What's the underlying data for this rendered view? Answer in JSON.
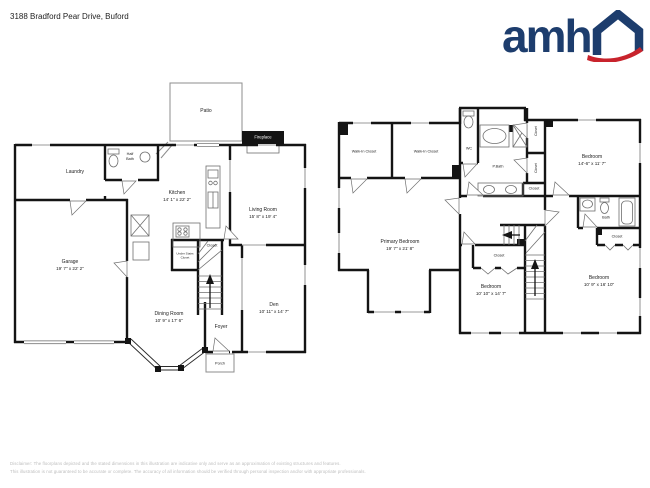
{
  "header": {
    "address": "3188 Bradford Pear Drive, Buford",
    "logo": {
      "text": "amh"
    }
  },
  "floor1": {
    "patio": {
      "label": "Patio"
    },
    "fireplace": {
      "label": "Fireplace"
    },
    "laundry": {
      "label": "Laundry"
    },
    "half_bath": {
      "label": "Half Bath"
    },
    "garage": {
      "label": "Garage",
      "dims": "19' 7\" x 22' 2\""
    },
    "kitchen": {
      "label": "Kitchen",
      "dims": "14' 1\" x 22' 2\""
    },
    "living_room": {
      "label": "Living Room",
      "dims": "15' 8\" x 19' 4\""
    },
    "dining_room": {
      "label": "Dining Room",
      "dims": "10' 9\" x 17' 6\""
    },
    "den": {
      "label": "Den",
      "dims": "10' 11\" x 14' 7\""
    },
    "foyer": {
      "label": "Foyer"
    },
    "porch": {
      "label": "Porch"
    },
    "closet": {
      "label": "Closet"
    },
    "under_stairs_closet": {
      "label": "Under Stairs Closet"
    }
  },
  "floor2": {
    "walk_in_closet_1": {
      "label": "Walk-In Closet"
    },
    "walk_in_closet_2": {
      "label": "Walk-In Closet"
    },
    "wc": {
      "label": "WC"
    },
    "p_bath": {
      "label": "P.Bath"
    },
    "bedroom_top": {
      "label": "Bedroom",
      "dims": "14'-6\" x 11' 7\""
    },
    "bath": {
      "label": "Bath"
    },
    "closet_bath": {
      "label": "Closet"
    },
    "primary_bedroom": {
      "label": "Primary Bedroom",
      "dims": "19' 7\" x 21' 8\""
    },
    "bedroom_mid": {
      "label": "Bedroom",
      "dims": "10' 10\" x 14' 7\""
    },
    "bedroom_right": {
      "label": "Bedroom",
      "dims": "10' 9\" x 16' 10\""
    },
    "closet_mid": {
      "label": "Closet"
    },
    "closet_hall": {
      "label": "Closet"
    },
    "closet_v1": {
      "label": "Closet"
    },
    "closet_v2": {
      "label": "Closet"
    }
  },
  "footer": {
    "line1": "Disclaimer: The floorplans depicted and the stated dimensions in this illustration are indicative only and serve as an approximation of existing structures and features.",
    "line2": "This illustration is not guaranteed to be accurate or complete. The accuracy of all information should be verified through personal inspection and/or with appropriate professionals."
  },
  "colors": {
    "wall": "#141414",
    "logo_blue": "#1d3d6d",
    "logo_red": "#c8232c",
    "disclaimer": "#bdbdbd"
  }
}
